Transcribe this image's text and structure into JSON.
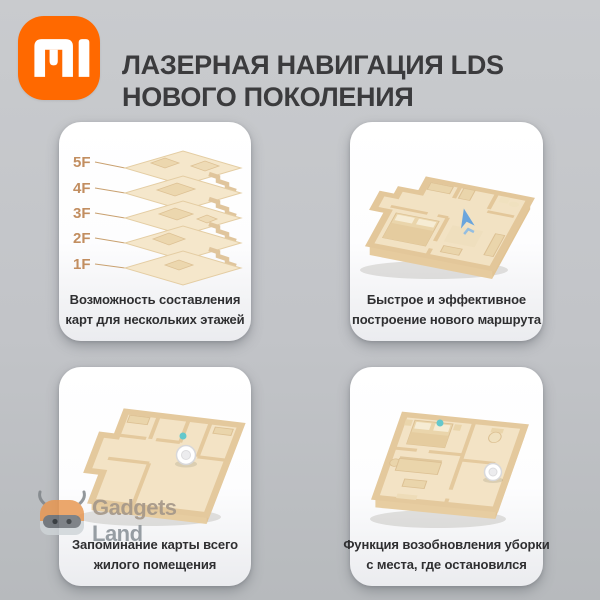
{
  "header": {
    "logo_icon": "xiaomi-mi-logo",
    "title_line1": "ЛАЗЕРНАЯ НАВИГАЦИЯ LDS",
    "title_line2": "НОВОГО ПОКОЛЕНИЯ"
  },
  "cards": [
    {
      "id": "multi-floor-maps",
      "caption_line1": "Возможность составления",
      "caption_line2": "карт для нескольких этажей",
      "floor_labels": [
        "5F",
        "4F",
        "3F",
        "2F",
        "1F"
      ]
    },
    {
      "id": "fast-route",
      "caption_line1": "Быстрое и эффективное",
      "caption_line2": "построение нового маршрута"
    },
    {
      "id": "map-memory",
      "caption_line1": "Запоминание карты всего",
      "caption_line2": "жилого помещения"
    },
    {
      "id": "resume-cleaning",
      "caption_line1": "Функция возобновления уборки",
      "caption_line2": "с места, где остановился"
    }
  ],
  "watermark": {
    "line1": "Gadgets",
    "line2": "Land"
  },
  "palette": {
    "brand-orange": "#ff6900",
    "background-top": "#c9cbce",
    "background-bottom": "#b7babd",
    "card-top": "#ffffff",
    "card-bottom": "#ebecef",
    "title-color": "#3b3b3d",
    "caption-color": "#2f2f31",
    "label-tan": "#c28e60",
    "floor-beige": "#f3e3c5",
    "wall-beige": "#e4c99d",
    "furniture-beige": "#ead5ab",
    "accent-blue": "#5b9fe0",
    "accent-teal": "#64c8cc",
    "watermark-warm": "#a5988a",
    "watermark-gray": "#8f969c"
  }
}
